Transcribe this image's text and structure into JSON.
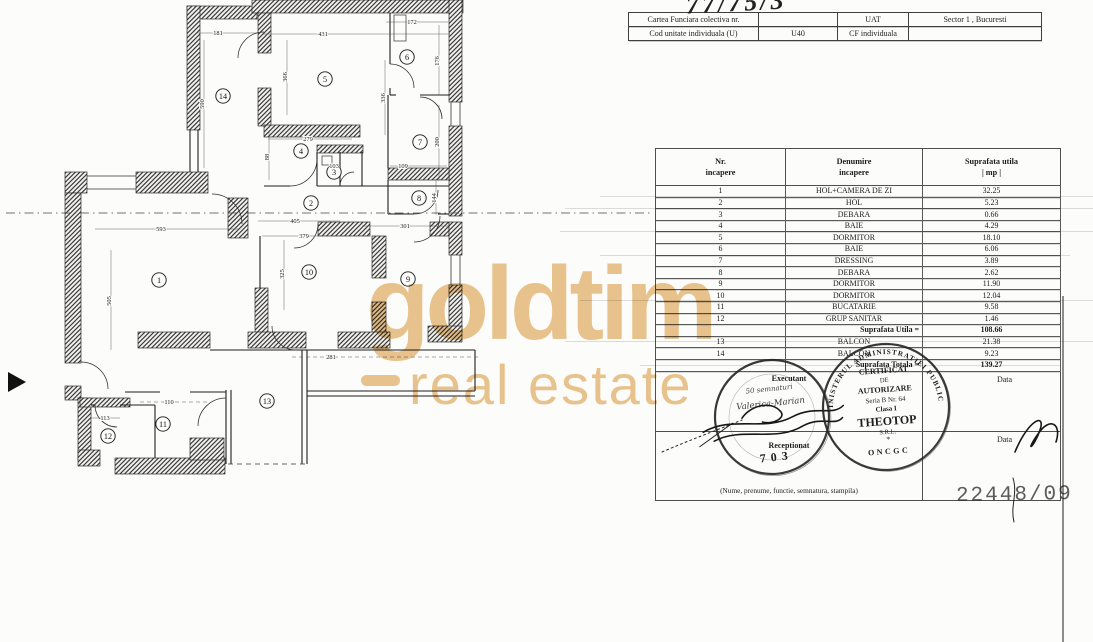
{
  "annotations": {
    "top_handwriting": "77/75/3",
    "registration_number": "22448/09"
  },
  "header_table": {
    "rows": [
      [
        "Cartea Funciara colectiva nr.",
        "",
        "UAT",
        "Sector 1 , Bucuresti"
      ],
      [
        "Cod unitate individuala (U)",
        "U40",
        "CF individuala",
        ""
      ]
    ]
  },
  "room_table": {
    "headers": [
      {
        "line1": "Nr.",
        "line2": "incapere"
      },
      {
        "line1": "Denumire",
        "line2": "incapere"
      },
      {
        "line1": "Suprafata utila",
        "line2": "| mp |"
      }
    ],
    "rows": [
      {
        "nr": "1",
        "name": "HOL+CAMERA DE ZI",
        "area": "32.25"
      },
      {
        "nr": "2",
        "name": "HOL",
        "area": "5.23"
      },
      {
        "nr": "3",
        "name": "DEBARA",
        "area": "0.66"
      },
      {
        "nr": "4",
        "name": "BAIE",
        "area": "4.29"
      },
      {
        "nr": "5",
        "name": "DORMITOR",
        "area": "18.10"
      },
      {
        "nr": "6",
        "name": "BAIE",
        "area": "6.06"
      },
      {
        "nr": "7",
        "name": "DRESSING",
        "area": "3.89"
      },
      {
        "nr": "8",
        "name": "DEBARA",
        "area": "2.62"
      },
      {
        "nr": "9",
        "name": "DORMITOR",
        "area": "11.90"
      },
      {
        "nr": "10",
        "name": "DORMITOR",
        "area": "12.04"
      },
      {
        "nr": "11",
        "name": "BUCATARIE",
        "area": "9.58"
      },
      {
        "nr": "12",
        "name": "GRUP SANITAR",
        "area": "1.46"
      },
      {
        "nr": "",
        "name": "Suprafata Utila =",
        "area": "108.66",
        "style": "subtotal"
      },
      {
        "nr": "13",
        "name": "BALCON",
        "area": "21.38"
      },
      {
        "nr": "14",
        "name": "BALCON",
        "area": "9.23"
      },
      {
        "nr": "",
        "name": "Suprafata Totala =",
        "area": "139.27",
        "style": "subtotal"
      }
    ],
    "footer": {
      "executant_label": "Executant",
      "receptionat_label": "Receptionat",
      "data_label_1": "Data",
      "data_label_2": "Data",
      "caption": "(Nume, prenume, functie, semnatura, stampila)"
    }
  },
  "stamps": {
    "left": {
      "script_line_1": "50 semnaturi",
      "script_line_2": "Valerica-Marian",
      "number": "703"
    },
    "right": {
      "ring_text": "MINISTERUL ADMINISTRATIEI PUBLICE",
      "lines": [
        "CERTIFICAT",
        "DE",
        "AUTORIZARE",
        "Seria B Nr. 64",
        "Clasa I",
        "THEOTOP",
        "S.R.L.",
        "*"
      ],
      "bottom_text": "ONCGC"
    }
  },
  "watermark": {
    "brand": "goldtim",
    "tagline": "real estate",
    "color": "#eac58f"
  },
  "floorplan": {
    "room_labels": [
      {
        "n": "1",
        "x": 159,
        "y": 280
      },
      {
        "n": "2",
        "x": 311,
        "y": 203
      },
      {
        "n": "3",
        "x": 334,
        "y": 172
      },
      {
        "n": "4",
        "x": 301,
        "y": 151
      },
      {
        "n": "5",
        "x": 325,
        "y": 79
      },
      {
        "n": "6",
        "x": 407,
        "y": 57
      },
      {
        "n": "7",
        "x": 420,
        "y": 142
      },
      {
        "n": "8",
        "x": 419,
        "y": 198
      },
      {
        "n": "9",
        "x": 408,
        "y": 279
      },
      {
        "n": "10",
        "x": 309,
        "y": 272
      },
      {
        "n": "11",
        "x": 163,
        "y": 424
      },
      {
        "n": "12",
        "x": 108,
        "y": 436
      },
      {
        "n": "13",
        "x": 267,
        "y": 401
      },
      {
        "n": "14",
        "x": 223,
        "y": 96
      }
    ],
    "dim_labels": [
      {
        "t": "181",
        "x": 218,
        "y": 35,
        "r": 0
      },
      {
        "t": "431",
        "x": 323,
        "y": 36,
        "r": 0
      },
      {
        "t": "172",
        "x": 412,
        "y": 24,
        "r": 0
      },
      {
        "t": "590",
        "x": 204,
        "y": 104,
        "r": -90
      },
      {
        "t": "366",
        "x": 287,
        "y": 77,
        "r": -90
      },
      {
        "t": "336",
        "x": 385,
        "y": 98,
        "r": -90
      },
      {
        "t": "176",
        "x": 439,
        "y": 61,
        "r": -90
      },
      {
        "t": "279",
        "x": 308,
        "y": 141,
        "r": 0
      },
      {
        "t": "88",
        "x": 269,
        "y": 157,
        "r": -90
      },
      {
        "t": "103",
        "x": 334,
        "y": 168,
        "r": 0
      },
      {
        "t": "109",
        "x": 403,
        "y": 168,
        "r": 0
      },
      {
        "t": "200",
        "x": 439,
        "y": 142,
        "r": -90
      },
      {
        "t": "144",
        "x": 436,
        "y": 198,
        "r": -90
      },
      {
        "t": "405",
        "x": 295,
        "y": 223,
        "r": 0
      },
      {
        "t": "379",
        "x": 304,
        "y": 238,
        "r": 0
      },
      {
        "t": "301",
        "x": 405,
        "y": 228,
        "r": 0
      },
      {
        "t": "593",
        "x": 161,
        "y": 231,
        "r": 0
      },
      {
        "t": "505",
        "x": 111,
        "y": 301,
        "r": -90
      },
      {
        "t": "325",
        "x": 284,
        "y": 274,
        "r": -90
      },
      {
        "t": "281",
        "x": 331,
        "y": 359,
        "r": 0
      },
      {
        "t": "113",
        "x": 105,
        "y": 420,
        "r": 0
      },
      {
        "t": "110",
        "x": 169,
        "y": 404,
        "r": 0
      }
    ]
  }
}
